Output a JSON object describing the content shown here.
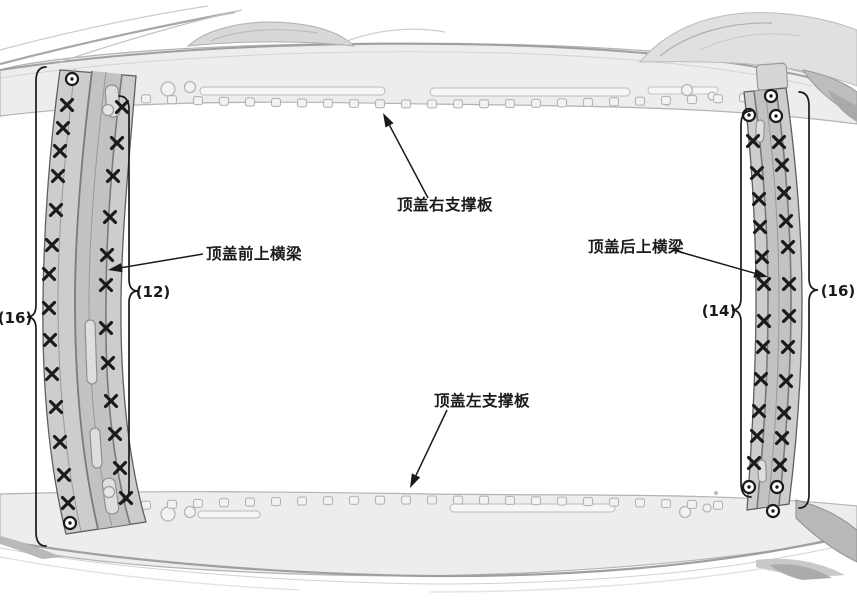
{
  "figure": {
    "title": "roof-crossmember-weld-location-diagram",
    "background": "#ffffff",
    "palette": {
      "ink": "#1a1a1a",
      "body_fill": "#ededed",
      "body_edge": "#9f9f9f",
      "member_fill": "#cdcdcd",
      "member_band": "#c2c2c2",
      "member_edge": "#5f5f5f"
    }
  },
  "part_labels": [
    {
      "id": "roof-right-stiffener",
      "text": "顶盖右支撑板",
      "x": 397,
      "y": 210,
      "leader": {
        "from": [
          428,
          198
        ],
        "to": [
          383,
          113
        ]
      }
    },
    {
      "id": "roof-front-upper-crossmember",
      "text": "顶盖前上横梁",
      "x": 206,
      "y": 259,
      "leader": {
        "from": [
          203,
          254
        ],
        "to": [
          108,
          270
        ]
      }
    },
    {
      "id": "roof-rear-upper-crossmember",
      "text": "顶盖后上横梁",
      "x": 588,
      "y": 252,
      "leader": {
        "from": [
          673,
          250
        ],
        "to": [
          768,
          277
        ]
      }
    },
    {
      "id": "roof-left-stiffener",
      "text": "顶盖左支撑板",
      "x": 434,
      "y": 406,
      "leader": {
        "from": [
          447,
          410
        ],
        "to": [
          410,
          488
        ]
      }
    }
  ],
  "weld_groups": [
    {
      "id": "front-crossmember-outer-row",
      "count_label": "(16)",
      "count_pos": [
        15,
        323
      ],
      "brace": {
        "x": 36,
        "y_top": 67,
        "y_mid": 317,
        "y_bottom": 546,
        "dir": "left"
      },
      "spot_welds": [
        [
          67,
          105
        ],
        [
          63,
          128
        ],
        [
          60,
          151
        ],
        [
          58,
          176
        ],
        [
          56,
          210
        ],
        [
          52,
          245
        ],
        [
          49,
          274
        ],
        [
          49,
          308
        ],
        [
          50,
          340
        ],
        [
          52,
          374
        ],
        [
          56,
          407
        ],
        [
          60,
          442
        ],
        [
          64,
          475
        ],
        [
          68,
          503
        ]
      ],
      "plug_welds": [
        [
          72,
          79
        ],
        [
          70,
          523
        ]
      ]
    },
    {
      "id": "front-crossmember-inner-row",
      "count_label": "(12)",
      "count_pos": [
        153,
        297
      ],
      "brace": {
        "x": 129,
        "y_top": 96,
        "y_mid": 291,
        "y_bottom": 503,
        "dir": "right"
      },
      "spot_welds": [
        [
          122,
          107
        ],
        [
          117,
          143
        ],
        [
          113,
          176
        ],
        [
          110,
          217
        ],
        [
          107,
          255
        ],
        [
          106,
          285
        ],
        [
          106,
          328
        ],
        [
          108,
          363
        ],
        [
          111,
          401
        ],
        [
          115,
          434
        ],
        [
          120,
          468
        ],
        [
          126,
          498
        ]
      ],
      "plug_welds": []
    },
    {
      "id": "rear-crossmember-inner-row",
      "count_label": "(14)",
      "count_pos": [
        719,
        316
      ],
      "brace": {
        "x": 741,
        "y_top": 111,
        "y_mid": 310,
        "y_bottom": 497,
        "dir": "left"
      },
      "spot_welds": [
        [
          753,
          141
        ],
        [
          757,
          173
        ],
        [
          759,
          199
        ],
        [
          760,
          227
        ],
        [
          762,
          257
        ],
        [
          764,
          284
        ],
        [
          764,
          321
        ],
        [
          763,
          347
        ],
        [
          761,
          379
        ],
        [
          759,
          411
        ],
        [
          757,
          436
        ],
        [
          754,
          463
        ]
      ],
      "plug_welds": [
        [
          749,
          115
        ],
        [
          749,
          487
        ]
      ]
    },
    {
      "id": "rear-crossmember-outer-row",
      "count_label": "(16)",
      "count_pos": [
        838,
        296
      ],
      "brace": {
        "x": 809,
        "y_top": 92,
        "y_mid": 290,
        "y_bottom": 508,
        "dir": "right"
      },
      "spot_welds": [
        [
          779,
          142
        ],
        [
          782,
          165
        ],
        [
          784,
          193
        ],
        [
          786,
          221
        ],
        [
          788,
          247
        ],
        [
          789,
          284
        ],
        [
          789,
          316
        ],
        [
          788,
          347
        ],
        [
          786,
          381
        ],
        [
          784,
          413
        ],
        [
          782,
          438
        ],
        [
          780,
          465
        ]
      ],
      "plug_welds": [
        [
          771,
          96
        ],
        [
          776,
          116
        ],
        [
          777,
          487
        ],
        [
          773,
          511
        ]
      ]
    }
  ]
}
